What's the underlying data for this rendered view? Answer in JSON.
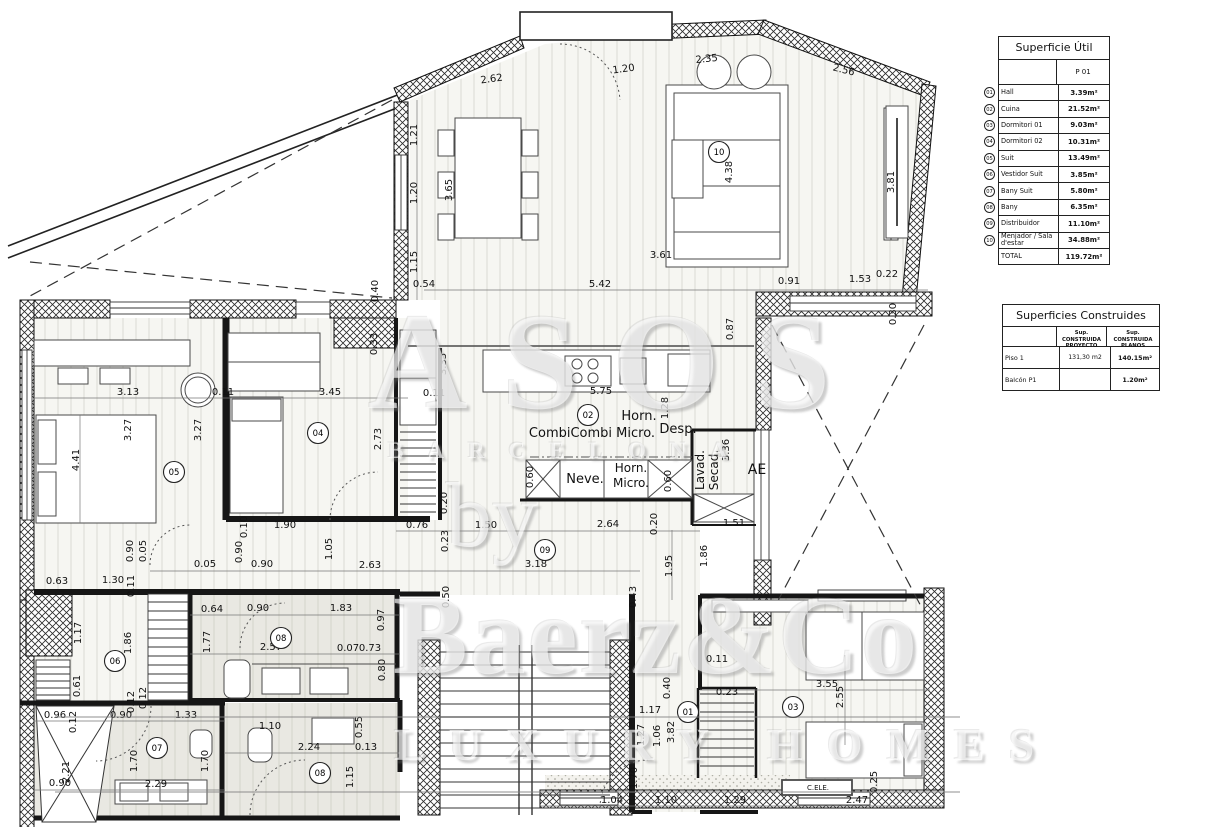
{
  "tables": {
    "superficie_util": {
      "title": "Superficie Útil",
      "col_header": "P 01",
      "rows": [
        {
          "num": "01",
          "name": "Hall",
          "value": "3.39m²"
        },
        {
          "num": "02",
          "name": "Cuina",
          "value": "21.52m²"
        },
        {
          "num": "03",
          "name": "Dormitori 01",
          "value": "9.03m²"
        },
        {
          "num": "04",
          "name": "Dormitori 02",
          "value": "10.31m²"
        },
        {
          "num": "05",
          "name": "Suit",
          "value": "13.49m²"
        },
        {
          "num": "06",
          "name": "Vestidor Suit",
          "value": "3.85m²"
        },
        {
          "num": "07",
          "name": "Bany Suit",
          "value": "5.80m²"
        },
        {
          "num": "08",
          "name": "Bany",
          "value": "6.35m²"
        },
        {
          "num": "09",
          "name": "Distribuidor",
          "value": "11.10m²"
        },
        {
          "num": "10",
          "name": "Menjador / Sala d'estar",
          "value": "34.88m²"
        }
      ],
      "total_label": "TOTAL",
      "total_value": "119.72m²"
    },
    "superficies_construides": {
      "title": "Superficies Construides",
      "col1": "Sup. CONSTRUIDA PROYECTO",
      "col2": "Sup. CONSTRUIDA PLANOS",
      "rows": [
        {
          "name": "Piso 1",
          "proyecto": "131,30 m2",
          "planos": "140.15m²"
        },
        {
          "name": "Balcón P1",
          "proyecto": "",
          "planos": "1.20m²"
        }
      ]
    }
  },
  "watermark": {
    "top_letters": "ASOS",
    "city": "BARCELONA",
    "by": "by",
    "brand": "Baerz&Co",
    "tagline": "LUXURY HOMES"
  },
  "plan": {
    "room_circles": [
      {
        "n": "01",
        "x": 688,
        "y": 712
      },
      {
        "n": "02",
        "x": 588,
        "y": 415
      },
      {
        "n": "03",
        "x": 793,
        "y": 707
      },
      {
        "n": "04",
        "x": 318,
        "y": 433
      },
      {
        "n": "05",
        "x": 174,
        "y": 472
      },
      {
        "n": "06",
        "x": 115,
        "y": 661
      },
      {
        "n": "07",
        "x": 157,
        "y": 748
      },
      {
        "n": "08",
        "x": 281,
        "y": 638
      },
      {
        "n": "08",
        "x": 320,
        "y": 773
      },
      {
        "n": "09",
        "x": 545,
        "y": 550
      },
      {
        "n": "10",
        "x": 719,
        "y": 152
      }
    ],
    "labels": [
      {
        "t": "Horn.",
        "x": 639,
        "y": 420,
        "r": 0,
        "s": 13
      },
      {
        "t": "CombiCombi Micro.",
        "x": 592,
        "y": 437,
        "r": 0,
        "s": 13
      },
      {
        "t": "Desp.",
        "x": 678,
        "y": 433,
        "r": 0,
        "s": 13
      },
      {
        "t": "Neve.",
        "x": 585,
        "y": 483,
        "r": 0,
        "s": 13
      },
      {
        "t": "Horn.",
        "x": 631,
        "y": 472,
        "r": 0,
        "s": 12
      },
      {
        "t": "Micro.",
        "x": 631,
        "y": 487,
        "r": 0,
        "s": 12
      },
      {
        "t": "Lavad.",
        "x": 704,
        "y": 470,
        "r": -90,
        "s": 12
      },
      {
        "t": "Secad.",
        "x": 718,
        "y": 470,
        "r": -90,
        "s": 12
      },
      {
        "t": "AE",
        "x": 757,
        "y": 474,
        "r": 0,
        "s": 14
      },
      {
        "t": "C.ELE.",
        "x": 818,
        "y": 790,
        "r": 0,
        "s": 7
      }
    ],
    "dims": [
      {
        "t": "2.62",
        "x": 492,
        "y": 82,
        "r": -8
      },
      {
        "t": "1.20",
        "x": 624,
        "y": 72,
        "r": -8
      },
      {
        "t": "2.35",
        "x": 707,
        "y": 62,
        "r": -6
      },
      {
        "t": "2.56",
        "x": 843,
        "y": 73,
        "r": 14
      },
      {
        "t": "1.21",
        "x": 417,
        "y": 135,
        "r": -90
      },
      {
        "t": "1.20",
        "x": 417,
        "y": 193,
        "r": -90
      },
      {
        "t": "1.15",
        "x": 417,
        "y": 262,
        "r": -90
      },
      {
        "t": "0.54",
        "x": 424,
        "y": 287,
        "r": 0
      },
      {
        "t": "5.42",
        "x": 600,
        "y": 287,
        "r": 0
      },
      {
        "t": "3.65",
        "x": 452,
        "y": 190,
        "r": -90
      },
      {
        "t": "4.38",
        "x": 732,
        "y": 172,
        "r": -90
      },
      {
        "t": "3.61",
        "x": 661,
        "y": 258,
        "r": 0
      },
      {
        "t": "0.91",
        "x": 789,
        "y": 284,
        "r": 0
      },
      {
        "t": "1.53",
        "x": 860,
        "y": 282,
        "r": 0
      },
      {
        "t": "0.22",
        "x": 887,
        "y": 277,
        "r": 0
      },
      {
        "t": "3.81",
        "x": 894,
        "y": 182,
        "r": -90
      },
      {
        "t": "0.30",
        "x": 896,
        "y": 314,
        "r": -90
      },
      {
        "t": "0.87",
        "x": 733,
        "y": 329,
        "r": -90
      },
      {
        "t": "0.40",
        "x": 378,
        "y": 291,
        "r": -90
      },
      {
        "t": "0.33",
        "x": 377,
        "y": 344,
        "r": -90
      },
      {
        "t": "3.35",
        "x": 446,
        "y": 364,
        "r": -90
      },
      {
        "t": "0.11",
        "x": 434,
        "y": 396,
        "r": 0
      },
      {
        "t": "2.73",
        "x": 381,
        "y": 439,
        "r": -90
      },
      {
        "t": "0.20",
        "x": 447,
        "y": 503,
        "r": -90
      },
      {
        "t": "0.76",
        "x": 417,
        "y": 528,
        "r": 0
      },
      {
        "t": "0.23",
        "x": 448,
        "y": 541,
        "r": -90
      },
      {
        "t": "1.50",
        "x": 486,
        "y": 528,
        "r": 0
      },
      {
        "t": "2.64",
        "x": 608,
        "y": 527,
        "r": 0
      },
      {
        "t": "0.20",
        "x": 657,
        "y": 524,
        "r": -90
      },
      {
        "t": "3.18",
        "x": 536,
        "y": 567,
        "r": 0
      },
      {
        "t": "0.50",
        "x": 449,
        "y": 597,
        "r": -90
      },
      {
        "t": "0.43",
        "x": 636,
        "y": 597,
        "r": -90
      },
      {
        "t": "1.95",
        "x": 672,
        "y": 566,
        "r": -90
      },
      {
        "t": "1.86",
        "x": 707,
        "y": 556,
        "r": -90
      },
      {
        "t": "1.51",
        "x": 734,
        "y": 526,
        "r": 0
      },
      {
        "t": "5.75",
        "x": 601,
        "y": 394,
        "r": 0
      },
      {
        "t": "1.28",
        "x": 668,
        "y": 408,
        "r": -90
      },
      {
        "t": "0.60",
        "x": 533,
        "y": 477,
        "r": -90
      },
      {
        "t": "0.60",
        "x": 671,
        "y": 481,
        "r": -90
      },
      {
        "t": "3.36",
        "x": 729,
        "y": 450,
        "r": -90
      },
      {
        "t": "3.13",
        "x": 128,
        "y": 395,
        "r": 0
      },
      {
        "t": "0.11",
        "x": 223,
        "y": 395,
        "r": 0
      },
      {
        "t": "3.45",
        "x": 330,
        "y": 395,
        "r": 0
      },
      {
        "t": "4.41",
        "x": 79,
        "y": 460,
        "r": -90
      },
      {
        "t": "3.27",
        "x": 131,
        "y": 430,
        "r": -90
      },
      {
        "t": "3.27",
        "x": 201,
        "y": 430,
        "r": -90
      },
      {
        "t": "0.90",
        "x": 133,
        "y": 551,
        "r": -90
      },
      {
        "t": "0.05",
        "x": 146,
        "y": 551,
        "r": -90
      },
      {
        "t": "0.05",
        "x": 205,
        "y": 567,
        "r": 0
      },
      {
        "t": "0.90",
        "x": 242,
        "y": 552,
        "r": -90
      },
      {
        "t": "0.90",
        "x": 262,
        "y": 567,
        "r": 0
      },
      {
        "t": "1.05",
        "x": 332,
        "y": 549,
        "r": -90
      },
      {
        "t": "1.90",
        "x": 285,
        "y": 528,
        "r": 0
      },
      {
        "t": "0.10",
        "x": 247,
        "y": 527,
        "r": -90
      },
      {
        "t": "2.63",
        "x": 370,
        "y": 568,
        "r": 0
      },
      {
        "t": "0.63",
        "x": 57,
        "y": 584,
        "r": 0
      },
      {
        "t": "1.30",
        "x": 113,
        "y": 583,
        "r": 0
      },
      {
        "t": "0.11",
        "x": 134,
        "y": 586,
        "r": -90
      },
      {
        "t": "1.17",
        "x": 81,
        "y": 633,
        "r": -90
      },
      {
        "t": "1.86",
        "x": 131,
        "y": 643,
        "r": -90
      },
      {
        "t": "0.61",
        "x": 80,
        "y": 686,
        "r": -90
      },
      {
        "t": "0.12",
        "x": 134,
        "y": 702,
        "r": -90
      },
      {
        "t": "0.64",
        "x": 212,
        "y": 612,
        "r": 0
      },
      {
        "t": "0.90",
        "x": 258,
        "y": 611,
        "r": 0
      },
      {
        "t": "1.83",
        "x": 341,
        "y": 611,
        "r": 0
      },
      {
        "t": "1.77",
        "x": 210,
        "y": 642,
        "r": -90
      },
      {
        "t": "2.57",
        "x": 271,
        "y": 650,
        "r": 0
      },
      {
        "t": "0.07",
        "x": 348,
        "y": 651,
        "r": 0
      },
      {
        "t": "0.73",
        "x": 370,
        "y": 651,
        "r": 0
      },
      {
        "t": "0.97",
        "x": 384,
        "y": 620,
        "r": -90
      },
      {
        "t": "0.80",
        "x": 385,
        "y": 670,
        "r": -90
      },
      {
        "t": "0.96",
        "x": 55,
        "y": 718,
        "r": 0
      },
      {
        "t": "0.12",
        "x": 76,
        "y": 722,
        "r": -90
      },
      {
        "t": "0.90",
        "x": 121,
        "y": 718,
        "r": 0
      },
      {
        "t": "1.33",
        "x": 186,
        "y": 718,
        "r": 0
      },
      {
        "t": "0.12",
        "x": 146,
        "y": 698,
        "r": -90
      },
      {
        "t": "2.21",
        "x": 69,
        "y": 772,
        "r": -90
      },
      {
        "t": "0.90",
        "x": 60,
        "y": 786,
        "r": 0
      },
      {
        "t": "1.70",
        "x": 137,
        "y": 761,
        "r": -90
      },
      {
        "t": "1.70",
        "x": 208,
        "y": 761,
        "r": -90
      },
      {
        "t": "2.29",
        "x": 156,
        "y": 787,
        "r": 0
      },
      {
        "t": "1.10",
        "x": 270,
        "y": 729,
        "r": 0
      },
      {
        "t": "2.24",
        "x": 309,
        "y": 750,
        "r": 0
      },
      {
        "t": "0.55",
        "x": 362,
        "y": 727,
        "r": -90
      },
      {
        "t": "0.13",
        "x": 366,
        "y": 750,
        "r": 0
      },
      {
        "t": "1.15",
        "x": 353,
        "y": 777,
        "r": -90
      },
      {
        "t": "0.11",
        "x": 717,
        "y": 662,
        "r": 0
      },
      {
        "t": "0.40",
        "x": 670,
        "y": 688,
        "r": -90
      },
      {
        "t": "0.23",
        "x": 727,
        "y": 695,
        "r": 0
      },
      {
        "t": "3.55",
        "x": 827,
        "y": 687,
        "r": 0
      },
      {
        "t": "2.55",
        "x": 843,
        "y": 697,
        "r": -90
      },
      {
        "t": "1.17",
        "x": 650,
        "y": 713,
        "r": 0
      },
      {
        "t": "1.27",
        "x": 644,
        "y": 735,
        "r": -90
      },
      {
        "t": "1.06",
        "x": 660,
        "y": 736,
        "r": -90
      },
      {
        "t": "3.82",
        "x": 674,
        "y": 732,
        "r": -90
      },
      {
        "t": "1.70",
        "x": 637,
        "y": 778,
        "r": -90
      },
      {
        "t": "1.04",
        "x": 612,
        "y": 803,
        "r": 0
      },
      {
        "t": "1.10",
        "x": 666,
        "y": 803,
        "r": 0
      },
      {
        "t": "1.29",
        "x": 735,
        "y": 803,
        "r": 0
      },
      {
        "t": "2.47",
        "x": 857,
        "y": 803,
        "r": 0
      },
      {
        "t": "0.25",
        "x": 877,
        "y": 782,
        "r": -90
      }
    ]
  }
}
